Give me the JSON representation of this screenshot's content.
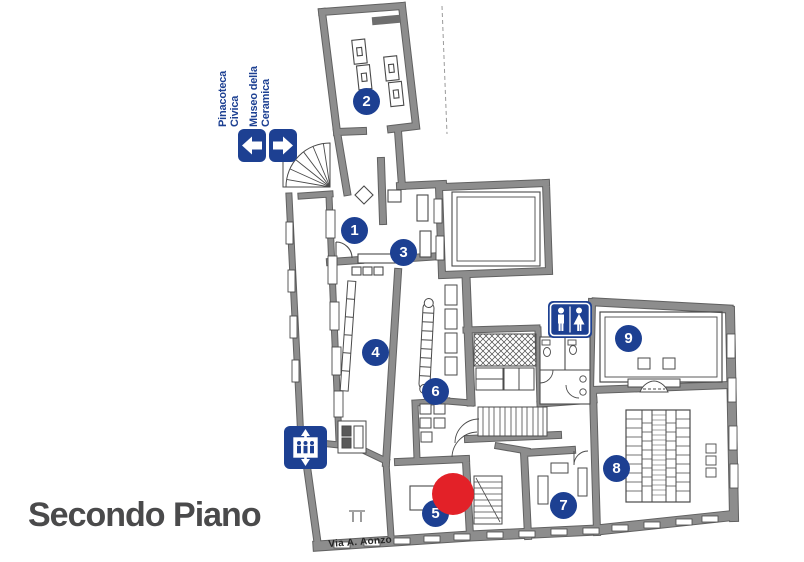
{
  "page": {
    "title": "Secondo Piano",
    "street_label": "Via A. Aonzo"
  },
  "direction_signs": [
    {
      "label_line1": "Pinacoteca",
      "label_line2": "Civica",
      "direction": "left",
      "icon": "arrow-left-icon"
    },
    {
      "label_line1": "Museo della",
      "label_line2": "Ceramica",
      "direction": "right",
      "icon": "arrow-right-icon"
    }
  ],
  "rooms": [
    {
      "number": "1"
    },
    {
      "number": "2"
    },
    {
      "number": "3"
    },
    {
      "number": "4"
    },
    {
      "number": "5"
    },
    {
      "number": "6"
    },
    {
      "number": "7"
    },
    {
      "number": "8"
    },
    {
      "number": "9"
    }
  ],
  "icons": {
    "restroom": "restroom-icon",
    "elevator": "elevator-icon",
    "you_are_here": "red-dot-marker"
  },
  "colors": {
    "accent_blue": "#1d4092",
    "marker_red": "#e32128",
    "wall_gray": "#8d8d8d",
    "line_dark": "#4a4a4a",
    "title_gray": "#4a4a4b"
  }
}
